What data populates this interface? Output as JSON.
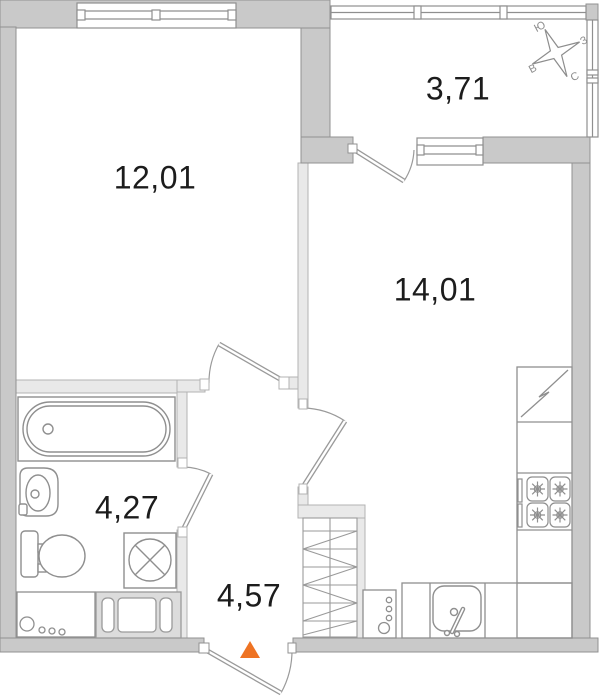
{
  "plan": {
    "title": "apartment-floor-plan",
    "rooms": [
      {
        "id": "bedroom",
        "area": "12,01"
      },
      {
        "id": "balcony",
        "area": "3,71"
      },
      {
        "id": "living-kitchen",
        "area": "14,01"
      },
      {
        "id": "bathroom",
        "area": "4,27"
      },
      {
        "id": "hallway",
        "area": "4,57"
      }
    ],
    "compass": {
      "north": "С",
      "south": "Ю",
      "west": "З",
      "east": "В"
    },
    "colors": {
      "wall_exterior": "#c9c9c9",
      "wall_interior": "#e9e9e9",
      "line": "#8f8f8f",
      "entrance_marker": "#ee7323",
      "text": "#1c1c1c"
    }
  }
}
